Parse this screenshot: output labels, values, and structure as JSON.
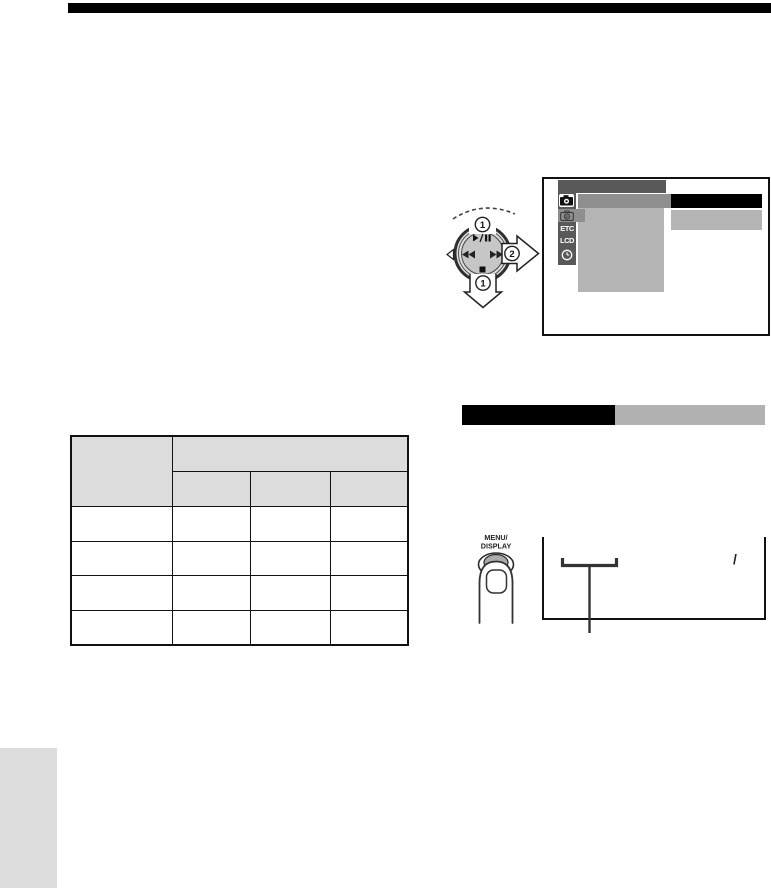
{
  "page": {
    "background": "#ffffff",
    "top_rule_color": "#000000"
  },
  "dial_diagram": {
    "markers": [
      "1",
      "1",
      "2"
    ],
    "symbols": {
      "top": "play-pause",
      "left": "rewind",
      "right": "fast-forward",
      "bottom": "stop"
    },
    "disc_color": "#c6c6c6"
  },
  "menu_screen": {
    "colors": {
      "dark": "#595959",
      "medium": "#8f8f8f",
      "light": "#b4b4b4",
      "selected_value": "#000000"
    },
    "sidebar": {
      "items": [
        {
          "icon": "camera-icon",
          "label": ""
        },
        {
          "icon": "camera-program-icon",
          "label": ""
        },
        {
          "icon": "",
          "label": "ETC"
        },
        {
          "icon": "",
          "label": "LCD"
        },
        {
          "icon": "clock-icon",
          "label": ""
        }
      ]
    }
  },
  "section_header": {
    "black_label": "",
    "gray_label": "",
    "black_color": "#000000",
    "gray_color": "#b1b1b1"
  },
  "table": {
    "corner_header": "",
    "group_header": "",
    "sub_headers": [
      "",
      "",
      ""
    ],
    "rows": [
      [
        "",
        "",
        "",
        ""
      ],
      [
        "",
        "",
        "",
        ""
      ],
      [
        "",
        "",
        "",
        ""
      ],
      [
        "",
        "",
        "",
        ""
      ]
    ],
    "header_bg": "#dcdcdc"
  },
  "button_callout": {
    "label_line1": "MENU/",
    "label_line2": "DISPLAY"
  },
  "playback_screen": {
    "slash": "/"
  }
}
